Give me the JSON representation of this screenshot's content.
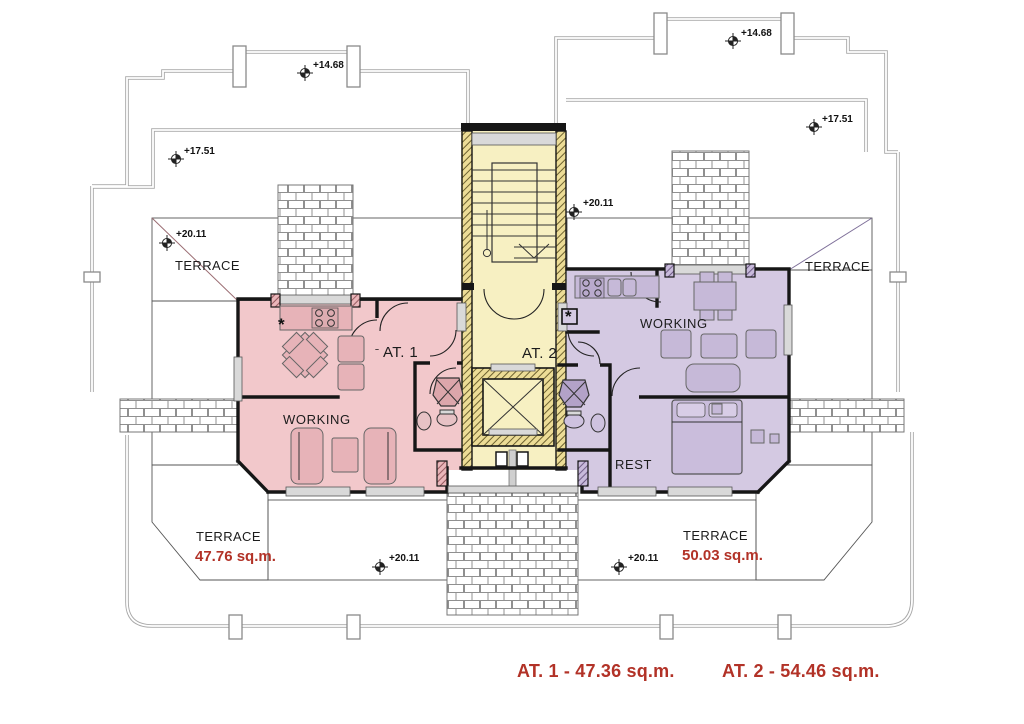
{
  "plan": {
    "apartment1": {
      "name": "AT. 1",
      "working_label": "WORKING",
      "terrace_top": "TERRACE",
      "terrace_bottom": "TERRACE",
      "terrace_area": "47.76 sq.m."
    },
    "apartment2": {
      "name": "AT. 2",
      "working_label": "WORKING",
      "rest_label": "REST",
      "terrace_top": "TERRACE",
      "terrace_bottom": "TERRACE",
      "terrace_area": "50.03 sq.m."
    },
    "markers": {
      "upper_left": "+14.68",
      "upper_right": "+14.68",
      "mid_left": "+17.51",
      "mid_right": "+17.51",
      "terrace_top_left": "+20.11",
      "terrace_top_right": "+20.11",
      "terrace_bottom_left": "+20.11",
      "terrace_bottom_right": "+20.11"
    },
    "legend": {
      "at1": "AT. 1 - 47.36 sq.m.",
      "at2": "AT. 2 - 54.46 sq.m."
    },
    "symbols": {
      "kitchen_star": "*"
    },
    "colors": {
      "apartment1_fill": "#f2c8cb",
      "apartment2_fill": "#d4c9e2",
      "terrace1_fill": "#eec1c5",
      "terrace2_fill": "#d1c6e0",
      "core_fill": "#f7f0c2",
      "wall": "#161616",
      "railing": "#a8a8a8",
      "area_text": "#b23227"
    }
  }
}
